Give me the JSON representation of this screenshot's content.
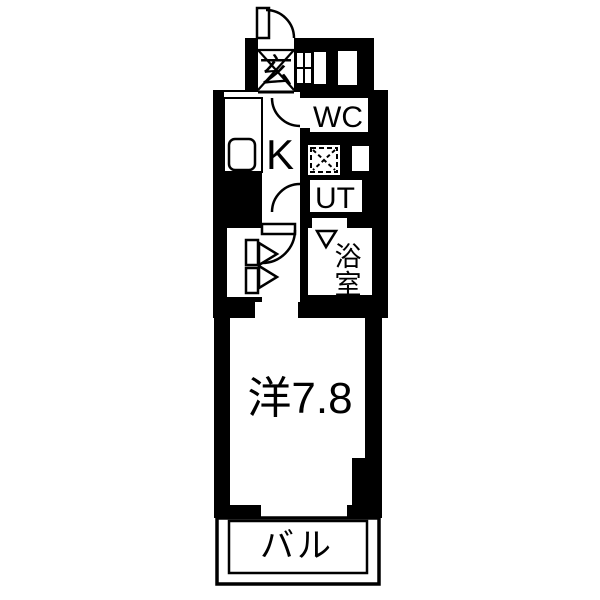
{
  "page": {
    "background": "#ffffff"
  },
  "floorplan": {
    "kind": "japanese-apartment-1K-floor-plan",
    "wall_color": "#000000",
    "floor_color": "#ffffff",
    "labels": {
      "entrance": "玄",
      "toilet": "WC",
      "kitchen": "K",
      "utility": "UT",
      "bathroom": "浴室",
      "main_room": "洋7.8",
      "balcony": "バル"
    }
  }
}
